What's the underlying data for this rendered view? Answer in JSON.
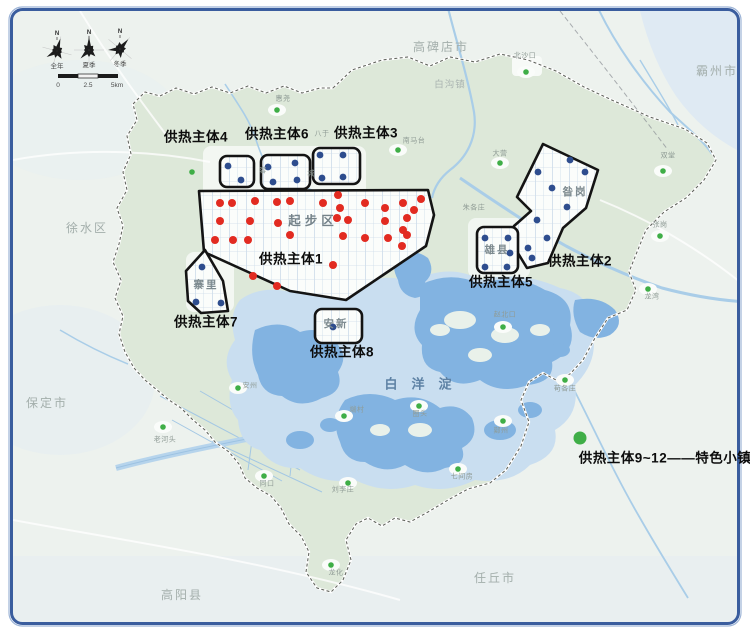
{
  "map": {
    "colors": {
      "red": "#e22b21",
      "blue": "#2e4d8e",
      "green": "#3fae47",
      "zone_outline": "#141414",
      "water_deep": "#82b3e1",
      "water_light": "#c9def0",
      "land_inside": "#dde8d9",
      "land_outside": "#edf2ee",
      "frame_border": "#3a5d9e"
    },
    "zones": [
      {
        "id": "1",
        "label": "供热主体1",
        "label_pos": [
          291,
          259
        ],
        "inner_label": "起步区",
        "inner_pos": [
          313,
          221
        ],
        "points": [
          [
            199,
            191
          ],
          [
            428,
            190
          ],
          [
            434,
            215
          ],
          [
            426,
            246
          ],
          [
            346,
            300
          ],
          [
            290,
            291
          ],
          [
            204,
            252
          ]
        ],
        "dot_color": "#e22b21",
        "dots": [
          [
            220,
            203
          ],
          [
            232,
            203
          ],
          [
            255,
            201
          ],
          [
            277,
            202
          ],
          [
            290,
            201
          ],
          [
            323,
            203
          ],
          [
            338,
            195
          ],
          [
            340,
            208
          ],
          [
            365,
            203
          ],
          [
            385,
            208
          ],
          [
            403,
            203
          ],
          [
            414,
            210
          ],
          [
            421,
            199
          ],
          [
            220,
            221
          ],
          [
            250,
            221
          ],
          [
            278,
            223
          ],
          [
            290,
            235
          ],
          [
            337,
            218
          ],
          [
            348,
            220
          ],
          [
            385,
            221
          ],
          [
            407,
            218
          ],
          [
            403,
            230
          ],
          [
            215,
            240
          ],
          [
            233,
            240
          ],
          [
            248,
            240
          ],
          [
            343,
            236
          ],
          [
            365,
            238
          ],
          [
            388,
            238
          ],
          [
            407,
            235
          ],
          [
            402,
            246
          ],
          [
            333,
            265
          ],
          [
            253,
            276
          ],
          [
            277,
            286
          ]
        ]
      },
      {
        "id": "2",
        "label": "供热主体2",
        "label_pos": [
          580,
          261
        ],
        "inner_label": "昝岗",
        "inner_pos": [
          575,
          192
        ],
        "points": [
          [
            543,
            144
          ],
          [
            598,
            170
          ],
          [
            586,
            208
          ],
          [
            563,
            228
          ],
          [
            548,
            263
          ],
          [
            527,
            268
          ],
          [
            513,
            245
          ],
          [
            514,
            226
          ],
          [
            531,
            211
          ],
          [
            517,
            197
          ]
        ],
        "dot_color": "#2e4d8e",
        "dots": [
          [
            570,
            160
          ],
          [
            585,
            172
          ],
          [
            538,
            172
          ],
          [
            552,
            188
          ],
          [
            567,
            207
          ],
          [
            537,
            220
          ],
          [
            547,
            238
          ],
          [
            528,
            248
          ],
          [
            532,
            258
          ]
        ]
      },
      {
        "id": "3",
        "label": "供热主体3",
        "label_pos": [
          366,
          133
        ],
        "rect": [
          313,
          148,
          47,
          36
        ],
        "dot_color": "#2e4d8e",
        "dots": [
          [
            320,
            155
          ],
          [
            343,
            155
          ],
          [
            322,
            178
          ],
          [
            343,
            177
          ]
        ]
      },
      {
        "id": "4",
        "label": "供热主体4",
        "label_pos": [
          196,
          137
        ],
        "rect": [
          220,
          156,
          34,
          31
        ],
        "dot_color": "#2e4d8e",
        "dots": [
          [
            228,
            166
          ],
          [
            241,
            180
          ]
        ]
      },
      {
        "id": "5",
        "label": "供热主体5",
        "label_pos": [
          501,
          282
        ],
        "inner_label": "雄县",
        "inner_pos": [
          497,
          250
        ],
        "rect": [
          477,
          227,
          41,
          46
        ],
        "dot_color": "#2e4d8e",
        "dots": [
          [
            485,
            238
          ],
          [
            508,
            238
          ],
          [
            510,
            253
          ],
          [
            485,
            267
          ],
          [
            507,
            267
          ]
        ]
      },
      {
        "id": "6",
        "label": "供热主体6",
        "label_pos": [
          277,
          134
        ],
        "rect": [
          261,
          155,
          49,
          34
        ],
        "dot_color": "#2e4d8e",
        "dots": [
          [
            268,
            167
          ],
          [
            295,
            163
          ],
          [
            273,
            182
          ],
          [
            297,
            180
          ]
        ]
      },
      {
        "id": "7",
        "label": "供热主体7",
        "label_pos": [
          206,
          322
        ],
        "inner_label": "寨里",
        "inner_pos": [
          206,
          285
        ],
        "points": [
          [
            205,
            250
          ],
          [
            186,
            271
          ],
          [
            188,
            301
          ],
          [
            201,
            313
          ],
          [
            228,
            311
          ],
          [
            223,
            281
          ]
        ],
        "dot_color": "#2e4d8e",
        "dots": [
          [
            202,
            267
          ],
          [
            196,
            302
          ],
          [
            221,
            303
          ]
        ]
      },
      {
        "id": "8",
        "label": "供热主体8",
        "label_pos": [
          342,
          352
        ],
        "inner_label": "安新",
        "inner_pos": [
          336,
          324
        ],
        "rect": [
          315,
          309,
          47,
          34
        ],
        "dot_color": "#2e4d8e",
        "dots": [
          [
            333,
            327
          ]
        ]
      }
    ],
    "legend": {
      "text": "供热主体9~12——特色小镇",
      "dot": [
        580,
        438
      ],
      "text_pos": [
        665,
        458
      ],
      "dot_color": "#3fae47"
    },
    "city_labels": [
      {
        "text": "高碑店市",
        "pos": [
          441,
          47
        ]
      },
      {
        "text": "霸州市",
        "pos": [
          717,
          71
        ]
      },
      {
        "text": "徐水区",
        "pos": [
          87,
          228
        ]
      },
      {
        "text": "保定市",
        "pos": [
          47,
          403
        ]
      },
      {
        "text": "高阳县",
        "pos": [
          182,
          595
        ]
      },
      {
        "text": "任丘市",
        "pos": [
          495,
          578
        ]
      },
      {
        "text": "白沟镇",
        "pos": [
          450,
          85
        ],
        "small": true
      }
    ],
    "towns": [
      {
        "text": "北沙口",
        "label": [
          525,
          56
        ],
        "dot": [
          526,
          72
        ]
      },
      {
        "text": "南马台",
        "label": [
          414,
          141
        ],
        "dot": [
          398,
          150
        ]
      },
      {
        "text": "惠尧",
        "label": [
          283,
          99
        ],
        "dot": [
          277,
          110
        ]
      },
      {
        "text": "大营",
        "label": [
          500,
          154
        ],
        "dot": [
          500,
          163
        ]
      },
      {
        "text": "双堂",
        "label": [
          668,
          156
        ],
        "dot": [
          663,
          171
        ]
      },
      {
        "text": "张岗",
        "label": [
          660,
          225
        ],
        "dot": [
          660,
          236
        ]
      },
      {
        "text": "龙湾",
        "label": [
          652,
          297
        ],
        "dot": [
          648,
          289
        ]
      },
      {
        "text": "赵北口",
        "label": [
          505,
          315
        ],
        "dot": [
          503,
          327
        ]
      },
      {
        "text": "苟各庄",
        "label": [
          565,
          389
        ],
        "dot": [
          565,
          380
        ]
      },
      {
        "text": "鄚州",
        "label": [
          501,
          431
        ],
        "dot": [
          503,
          421
        ]
      },
      {
        "text": "七间房",
        "label": [
          462,
          477
        ],
        "dot": [
          458,
          469
        ]
      },
      {
        "text": "圈头",
        "label": [
          420,
          414
        ],
        "dot": [
          419,
          406
        ]
      },
      {
        "text": "端村",
        "label": [
          357,
          410
        ],
        "dot": [
          344,
          416
        ]
      },
      {
        "text": "刘李庄",
        "label": [
          343,
          490
        ],
        "dot": [
          348,
          483
        ]
      },
      {
        "text": "同口",
        "label": [
          267,
          484
        ],
        "dot": [
          264,
          476
        ]
      },
      {
        "text": "安州",
        "label": [
          250,
          386
        ],
        "dot": [
          238,
          388
        ]
      },
      {
        "text": "老河头",
        "label": [
          165,
          440
        ],
        "dot": [
          163,
          427
        ]
      },
      {
        "text": "龙化",
        "label": [
          336,
          573
        ],
        "dot": [
          331,
          565
        ]
      }
    ],
    "plain_labels": [
      {
        "text": "八于",
        "pos": [
          322,
          134
        ]
      },
      {
        "text": "朱各庄",
        "pos": [
          474,
          208
        ]
      },
      {
        "text": "容",
        "pos": [
          263,
          171
        ]
      },
      {
        "text": "城",
        "pos": [
          311,
          174
        ]
      }
    ],
    "unlabeled_green_dots": [
      [
        192,
        172
      ]
    ],
    "lake_label": {
      "text": "白洋淀",
      "pos": [
        425,
        384
      ]
    },
    "compass": {
      "north_label": "N",
      "north_pos": [
        [
          57,
          34
        ],
        [
          89,
          33
        ],
        [
          120,
          32
        ]
      ],
      "rose_labels": [
        "全年",
        "夏季",
        "冬季"
      ],
      "rose_label_pos": [
        [
          57,
          67
        ],
        [
          89,
          66
        ],
        [
          120,
          65
        ]
      ],
      "scale_ticks": [
        {
          "t": "0",
          "pos": [
            58,
            86
          ]
        },
        {
          "t": "2.5",
          "pos": [
            88,
            86
          ]
        },
        {
          "t": "5km",
          "pos": [
            117,
            86
          ]
        }
      ]
    }
  }
}
